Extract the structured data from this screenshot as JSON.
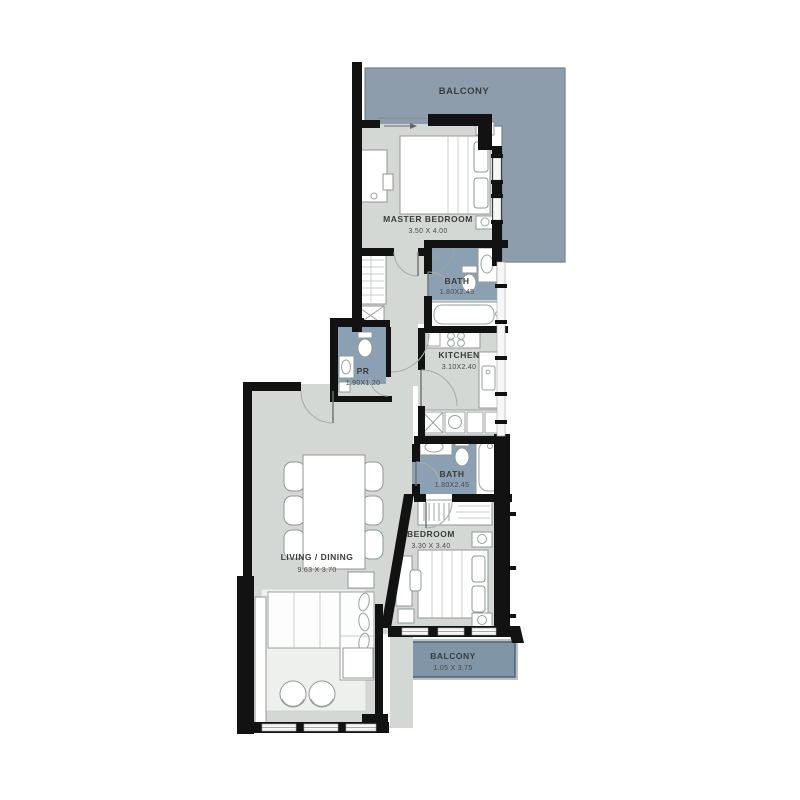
{
  "rooms": {
    "balcony_top": {
      "label": "BALCONY"
    },
    "master_bedroom": {
      "label": "MASTER BEDROOM",
      "dimensions": "3.50 X 4.00"
    },
    "master_bath": {
      "label": "BATH",
      "dimensions": "1.80X2.45"
    },
    "kitchen": {
      "label": "KITCHEN",
      "dimensions": "3.10X2.40"
    },
    "powder_room": {
      "label": "PR",
      "dimensions": "1.90X1.20"
    },
    "second_bath": {
      "label": "BATH",
      "dimensions": "1.80X2.45"
    },
    "bedroom": {
      "label": "BEDROOM",
      "dimensions": "3.30 X 3.40"
    },
    "living_dining": {
      "label": "LIVING / DINING",
      "dimensions": "9.63 X 3.70"
    },
    "balcony_bottom": {
      "label": "BALCONY",
      "dimensions": "1.05 X 3.75"
    }
  },
  "colors": {
    "floor": "#d3d8d5",
    "wet_area": "#8ba1b3",
    "balcony_upper": "#8d9dac",
    "balcony_lower": "#8095a6",
    "balcony_lower_frame": "#b9c1c6",
    "wall": "#121212",
    "label_text": "#3c3c3c"
  }
}
